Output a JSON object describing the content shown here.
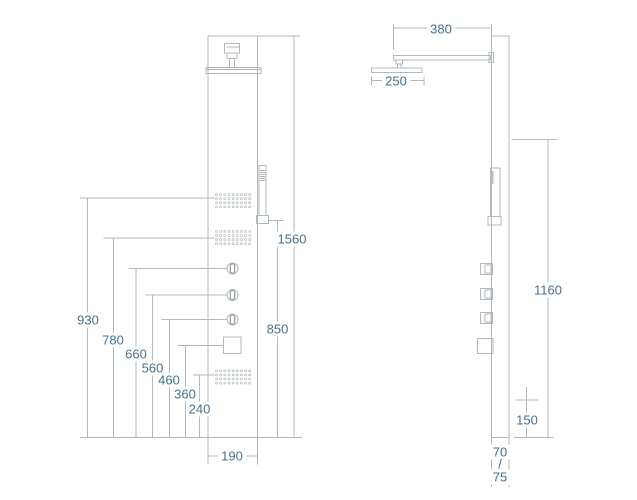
{
  "document": {
    "type": "technical dimension drawing",
    "subject": "shower panel front and side views"
  },
  "colors": {
    "line": "#b2b9bd",
    "knob_accent": "#99a1a6",
    "text": "#46718f",
    "background": "#ffffff"
  },
  "front_view": {
    "name": "front view",
    "dimensions": {
      "total_height": "1560",
      "upper_jets_height": "930",
      "hand_shower_height": "850",
      "mid_jets_height": "780",
      "knob_top_height": "660",
      "knob_middle_height": "560",
      "knob_bottom_height": "460",
      "diverter_height": "360",
      "lower_jets_height": "240",
      "panel_width": "190"
    }
  },
  "side_view": {
    "name": "side view",
    "dimensions": {
      "arm_projection": "380",
      "head_width": "250",
      "outlet_height": "1160",
      "bottom_offset": "150",
      "depth_top": "70",
      "depth_separator": "/",
      "depth_bottom": "75"
    }
  }
}
